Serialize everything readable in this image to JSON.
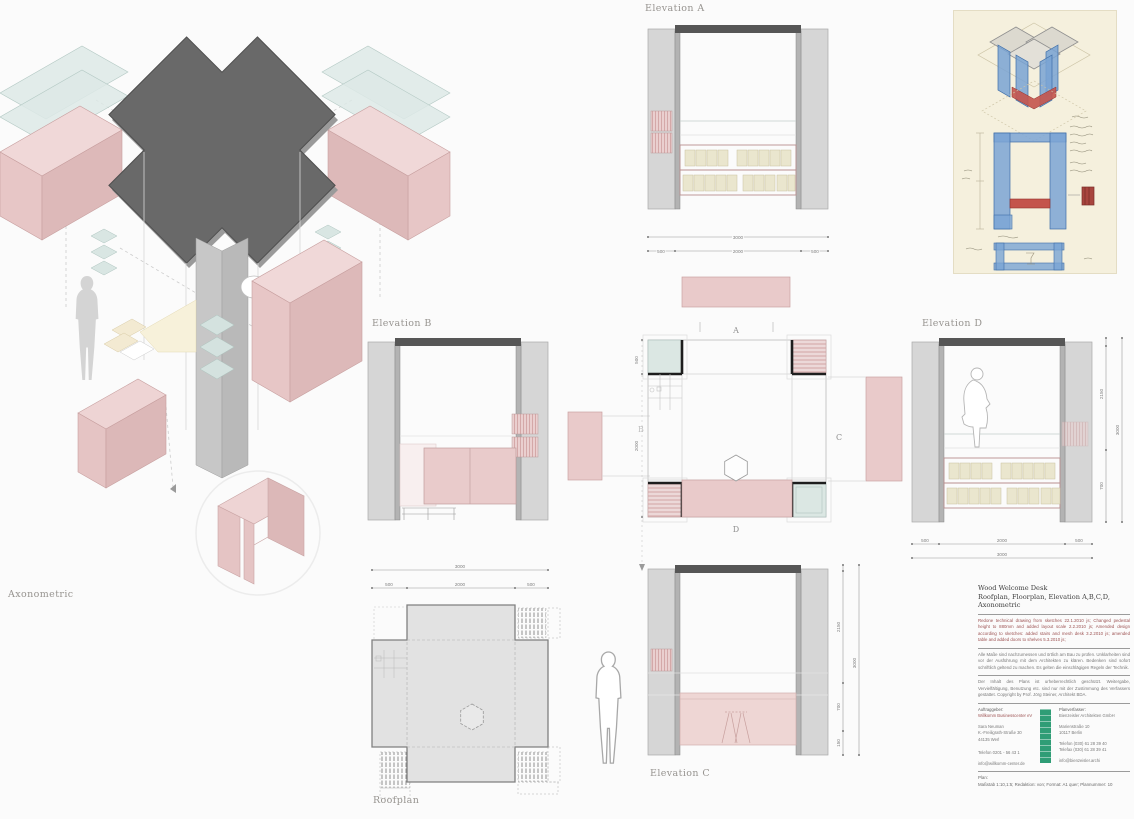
{
  "labels": {
    "axonometric": "Axonometric",
    "elevation_a": "Elevation A",
    "elevation_b": "Elevation B",
    "elevation_c": "Elevation C",
    "elevation_d": "Elevation D",
    "roofplan": "Roofplan"
  },
  "markers": {
    "a": "A",
    "b": "B",
    "c": "C",
    "d": "D"
  },
  "dims": {
    "elevA": {
      "overall": "3000",
      "segs": [
        "500",
        "2000",
        "500"
      ]
    },
    "elevD_bottom": {
      "overall": "3000",
      "segs": [
        "500",
        "2000",
        "500"
      ]
    },
    "elevD_right": {
      "overall": "3000",
      "segs": [
        "150",
        "2150",
        "700"
      ]
    },
    "elevC_right": {
      "overall": "3000",
      "segs": [
        "2150",
        "700",
        "150"
      ]
    },
    "roof": {
      "overall": "3000",
      "segs": [
        "500",
        "2000",
        "500"
      ]
    },
    "plan_left": {
      "segs": [
        "500",
        "2000"
      ]
    }
  },
  "titleblock": {
    "title1": "Wood Welcome Desk",
    "title2": "Roofplan, Floorplan, Elevation A,B,C,D,",
    "title3": "Axonometric",
    "revisions": "Redone technical drawing from sketches 22.1.2010 js; Changed pedestal height to 880mm and added layout scale 2.2.2010 js; Amended design according to sketches: added stairs and mesh desk 3.2.2010 js; amended table and added doors to shelves 5.3.2010 js;",
    "notes": "Alle Maße sind nachzumessen und örtlich am Bau zu prüfen. Unklarheiten sind vor der Ausführung mit dem Architekten zu klären. Bedenken sind sofort schriftlich geltend zu machen. Es gelten die einschlägigen Regeln der Technik.",
    "copyright": "Der Inhalt des Plans ist urheberrechtlich geschützt. Weitergabe, Vervielfältigung, Benutzung etc. sind nur mit der Zustimmung des Verfassers gestattet. Copyright by Prof. Jörg Steiner, Architekt BDA.",
    "client_label": "Auftraggeber:",
    "client_name": "Willkomm Businesscenter eV",
    "client_contact": "Sara Neuman",
    "client_street": "K.-Freiligrath-Straße 30",
    "client_city": "44135 Werl",
    "client_phone": "Telefon 0201 - 56 43 1",
    "client_email": "info@willkomm-center.de",
    "architect_label": "Planverfasser:",
    "architect_name": "Bienzeisler Architekten GmbH",
    "architect_street": "Marienstraße 10",
    "architect_city": "10117 Berlin",
    "architect_phone": "Telefon (030) 61 28 39 40",
    "architect_fax": "Telefax (030) 61 28 39 41",
    "architect_web": "info@bienzeisler.archi",
    "plan_label": "Plan:",
    "plan_info": "Maßstab 1:10,1:5;  Redaktion: von;  Format: A1 quer;  Plannummer: 10"
  },
  "colors": {
    "pink": "#e9caca",
    "pale_green": "#dbe7e3",
    "roof_dark": "#696969",
    "logo_green": "#2f9d76",
    "sketch_blue": "#79a3d3",
    "sketch_red": "#c4544c"
  }
}
